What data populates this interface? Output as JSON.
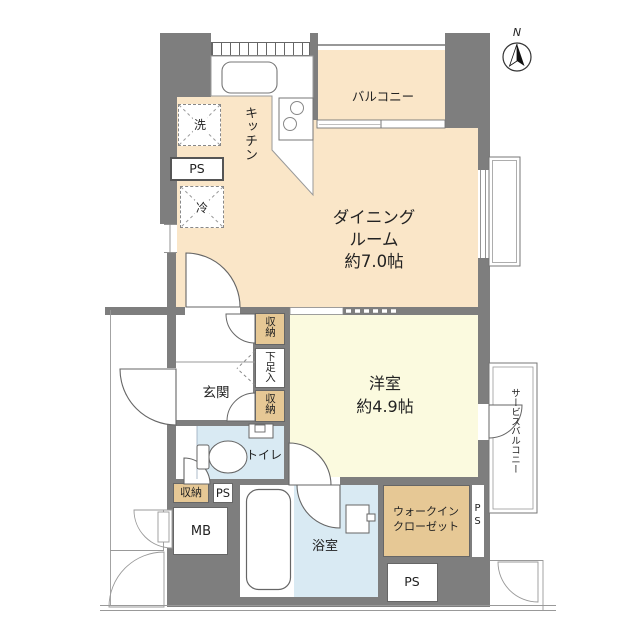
{
  "labels": {
    "compass_n": "N",
    "balcony": "バルコニー",
    "kitchen": "キッチン",
    "washer": "洗",
    "ps_top": "PS",
    "fridge": "冷",
    "dining_line1": "ダイニング",
    "dining_line2": "ルーム",
    "dining_line3": "約7.0帖",
    "storage_upper": "収納",
    "shoe_cabinet": "下足入",
    "storage_lower": "収納",
    "genkan": "玄関",
    "toilet": "トイレ",
    "western_line1": "洋室",
    "western_line2": "約4.9帖",
    "service_balcony": "サービスバルコニー",
    "storage_bottom": "収納",
    "ps_small": "PS",
    "mb": "MB",
    "bathroom": "浴室",
    "wic_line1": "ウォークイン",
    "wic_line2": "クローゼット",
    "ps_strip": "PS",
    "ps_box": "PS"
  },
  "colors": {
    "wall": "#7e7e7e",
    "dining_floor": "#fae6c8",
    "bedroom_floor": "#fbfadf",
    "wet_area_floor": "#d9eaf3",
    "closet_floor": "#e6c895",
    "outline": "#666666"
  }
}
